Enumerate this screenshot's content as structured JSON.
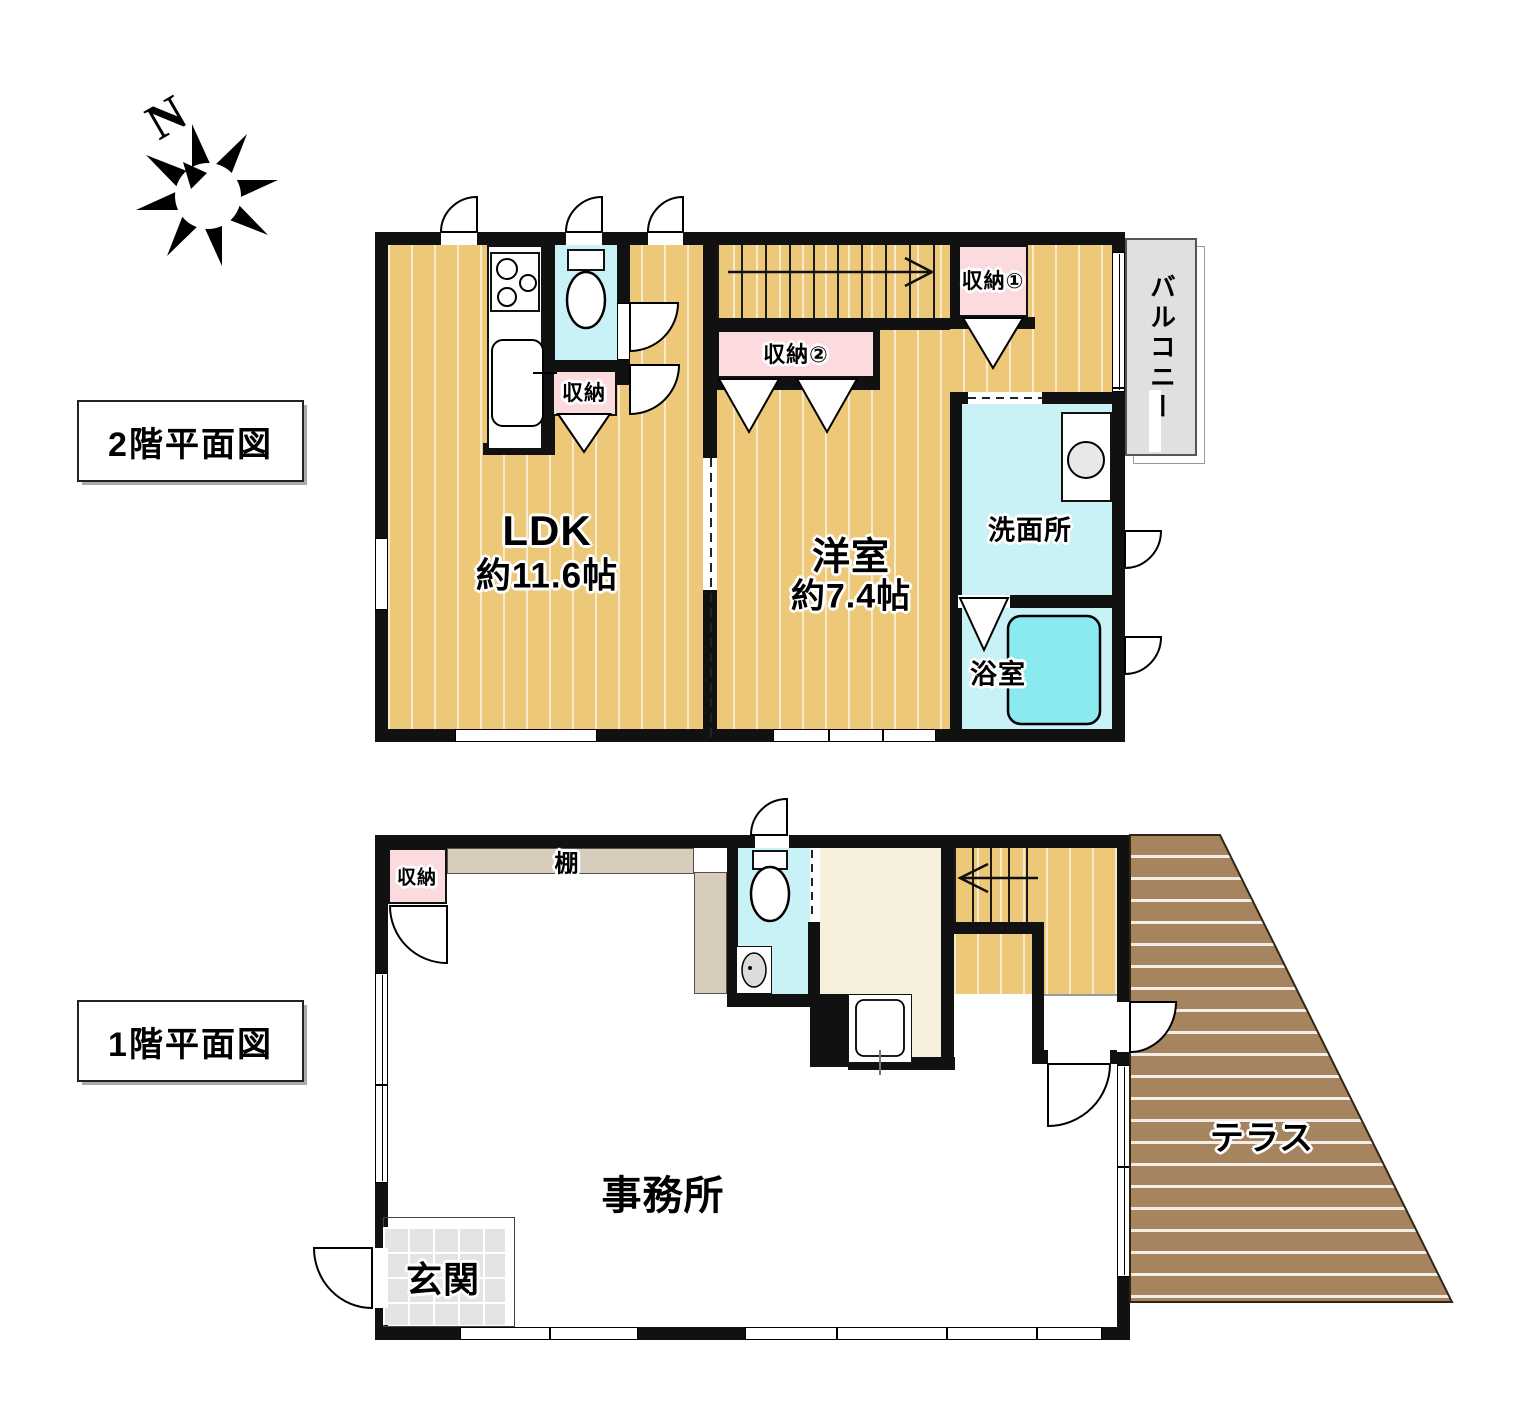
{
  "compass": {
    "label": "N"
  },
  "floor2": {
    "title": "2階平面図",
    "rooms": {
      "ldk": {
        "name": "LDK",
        "size": "約11.6帖"
      },
      "western_room": {
        "name": "洋室",
        "size": "約7.4帖"
      },
      "washroom": "洗面所",
      "bathroom": "浴室",
      "balcony": "バルコニー",
      "closet": "収納",
      "closet_1": "収納①",
      "closet_2": "収納②"
    }
  },
  "floor1": {
    "title": "1階平面図",
    "rooms": {
      "office": "事務所",
      "entrance": "玄関",
      "shelf": "棚",
      "closet": "収納",
      "terrace": "テラス"
    }
  },
  "colors": {
    "wall": "#111111",
    "floor_wood": "#ecc878",
    "terrace_wood": "#a5845f",
    "water_room": "#c9f2f7",
    "bathtub": "#8aeaf0",
    "closet_pink": "#fbdbde",
    "shelf_tan": "#d8ccbc",
    "cream_room": "#f6efdb",
    "tile_gray": "#e4e4e4",
    "balcony_gray": "#e0e0e0"
  }
}
